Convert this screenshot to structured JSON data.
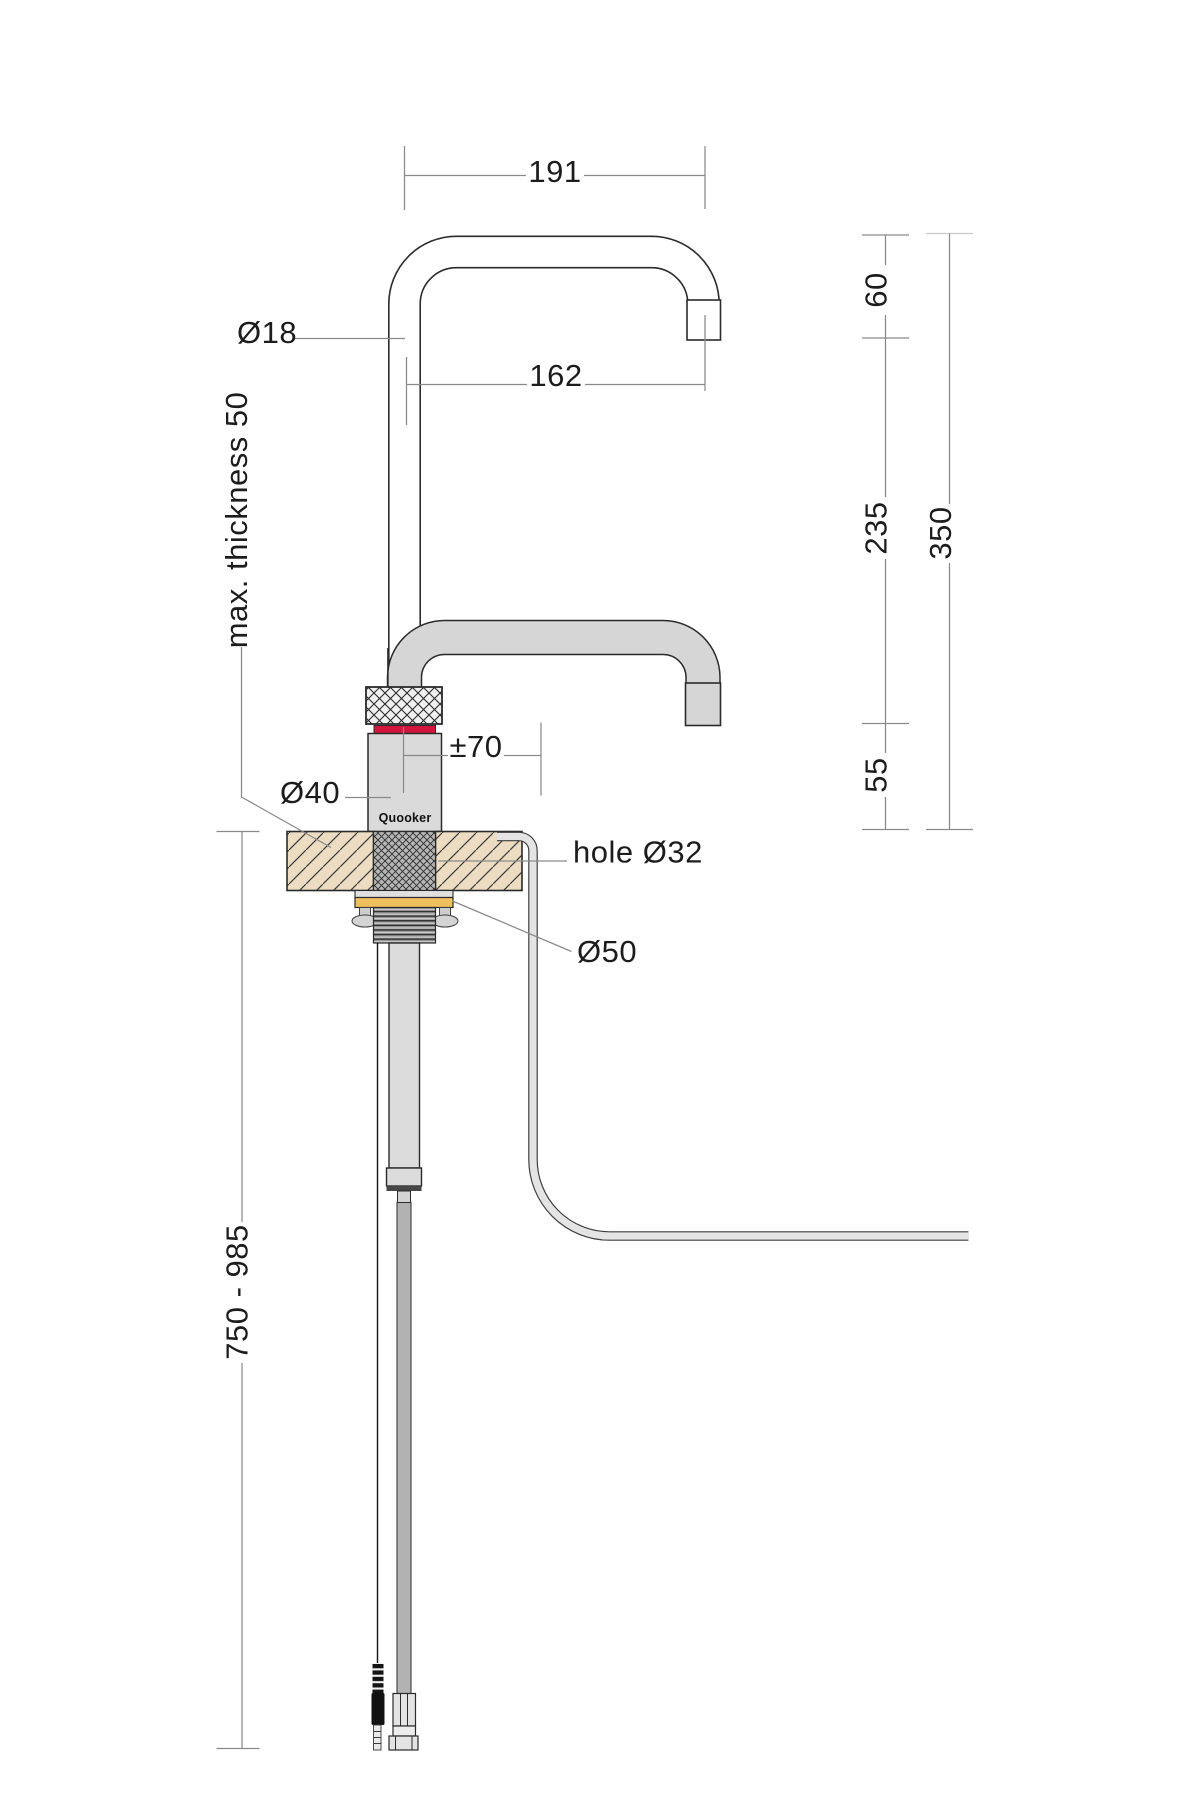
{
  "drawing": {
    "brand": "Quooker",
    "dimensions": {
      "spout_width_outer": "191",
      "spout_width_inner": "162",
      "spout_tube_diameter": "Ø18",
      "worktop_max_thickness": "max. thickness 50",
      "outlet_drop_top": "60",
      "outlet_drop_mid": "235",
      "total_height_above_worktop": "350",
      "short_outlet_clearance": "55",
      "height_adjust": "±70",
      "body_diameter": "Ø40",
      "mounting_hole": "hole Ø32",
      "washer_diameter": "Ø50",
      "under_counter_length": "750 - 985"
    },
    "colors": {
      "ink": "#2b2b2b",
      "dimension_line": "#8a8a8a",
      "metal_light": "#dcdcdc",
      "metal_mid": "#b2b2b2",
      "accent_red": "#d5163c",
      "washer_gold": "#eec05e",
      "worktop_tan": "#ecdcc1"
    }
  }
}
